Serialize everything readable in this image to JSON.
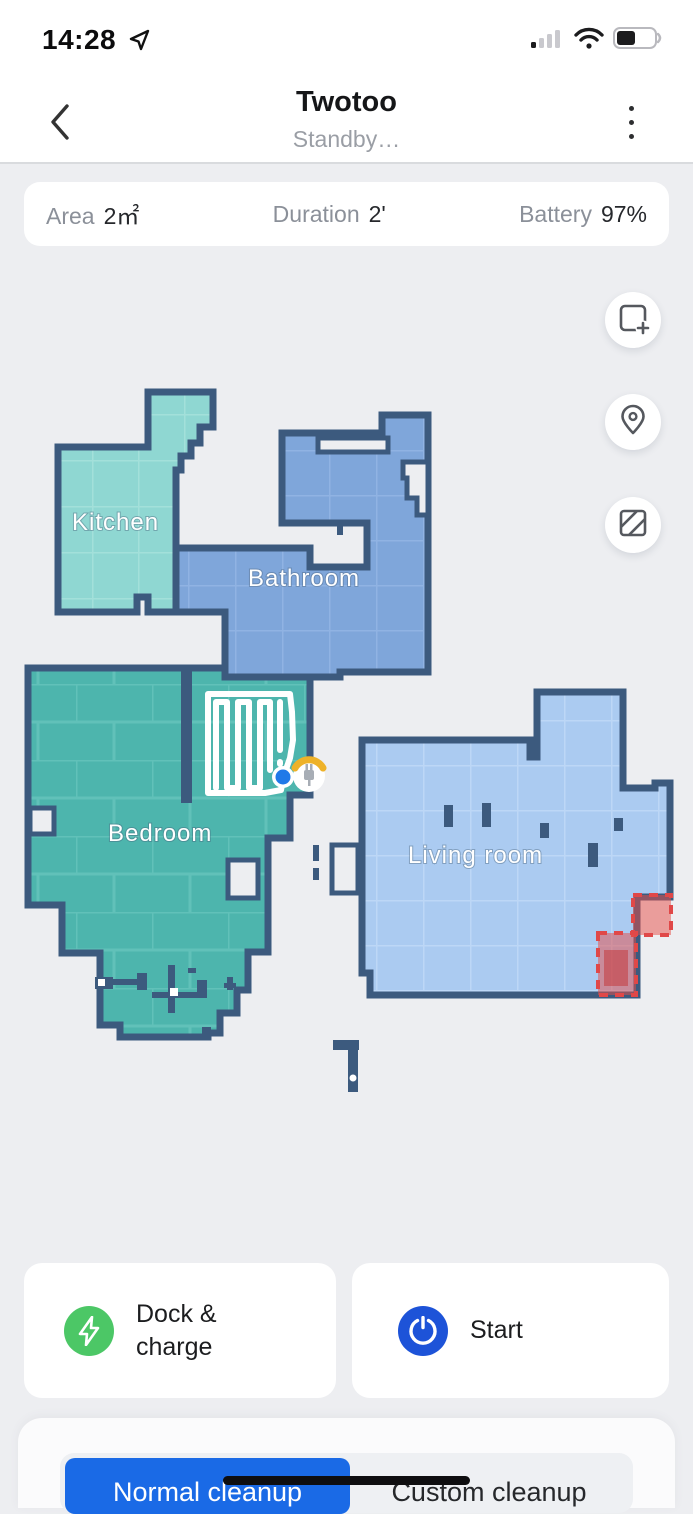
{
  "status_bar": {
    "time": "14:28"
  },
  "header": {
    "title": "Twotoo",
    "subtitle": "Standby…"
  },
  "stats": [
    {
      "label": "Area",
      "value": "2㎡"
    },
    {
      "label": "Duration",
      "value": "2'"
    },
    {
      "label": "Battery",
      "value": "97%"
    }
  ],
  "map": {
    "rooms": [
      {
        "name": "Kitchen",
        "color": "#8fd7d2"
      },
      {
        "name": "Bathroom",
        "color": "#7fa6da"
      },
      {
        "name": "Bedroom",
        "color": "#4db5ad"
      },
      {
        "name": "Living room",
        "color": "#abcbf1"
      }
    ],
    "wall_color": "#3c5a7e",
    "no_go_zone_color": "#e04848",
    "no_go_zones": 2,
    "robot_color": "#2079e8",
    "dock_accent_color": "#eeb229",
    "cleaned_path_color": "#ffffff"
  },
  "map_tools": [
    {
      "icon": "add-map-icon"
    },
    {
      "icon": "pin-icon"
    },
    {
      "icon": "no-go-zone-icon"
    }
  ],
  "actions": [
    {
      "label": "Dock & charge",
      "icon": "lightning-icon",
      "icon_bg": "#4cc766"
    },
    {
      "label": "Start",
      "icon": "power-icon",
      "icon_bg": "#1d53d8"
    }
  ],
  "bottom_sheet": {
    "tabs": [
      {
        "label": "Normal cleanup",
        "selected": true
      },
      {
        "label": "Custom cleanup",
        "selected": false
      }
    ],
    "selected_bg": "#1a6ae6"
  }
}
